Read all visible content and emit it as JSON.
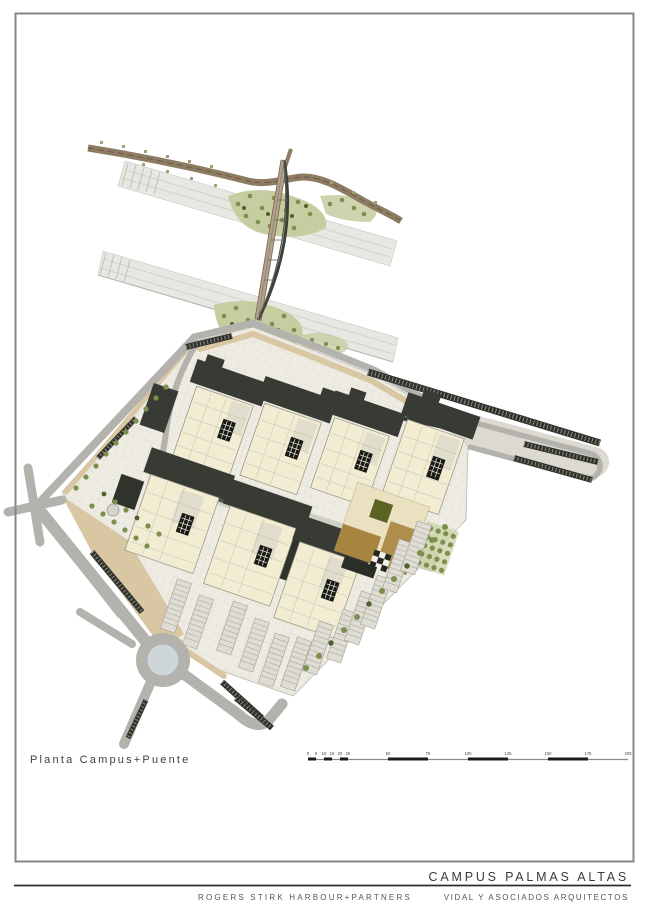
{
  "sheet": {
    "plan_title": "Planta Campus+Puente",
    "project_title": "CAMPUS PALMAS ALTAS",
    "architect_left": "ROGERS STIRK HARBOUR+PARTNERS",
    "architect_right": "VIDAL Y ASOCIADOS ARQUITECTOS"
  },
  "scalebar": {
    "unit_labels": [
      "0",
      "5",
      "10",
      "15",
      "20",
      "25",
      "50",
      "75",
      "100",
      "125",
      "150",
      "175",
      "200"
    ]
  },
  "palette": {
    "paper": "#ffffff",
    "frame": "#878787",
    "ink": "#3f3f3f",
    "rule": "#2d2d2d",
    "band": "#e8e7e2",
    "road_gray": "#b4b2ad",
    "road_tan": "#d9c7a3",
    "road_brown": "#8d7b62",
    "bridge_deck": "#b5a28a",
    "arch": "#3e3f39",
    "campus": "#edebe2",
    "plaza": "#d3d1c8",
    "cream": "#f1ecd2",
    "roof": "#383b34",
    "green": "#7d8f4e",
    "green_dark": "#4e6030",
    "green_light": "#c6cda1",
    "brown": "#a8853f",
    "olive": "#5a6322",
    "dark_strip": "#2f312b",
    "water": "#cfd6da"
  }
}
